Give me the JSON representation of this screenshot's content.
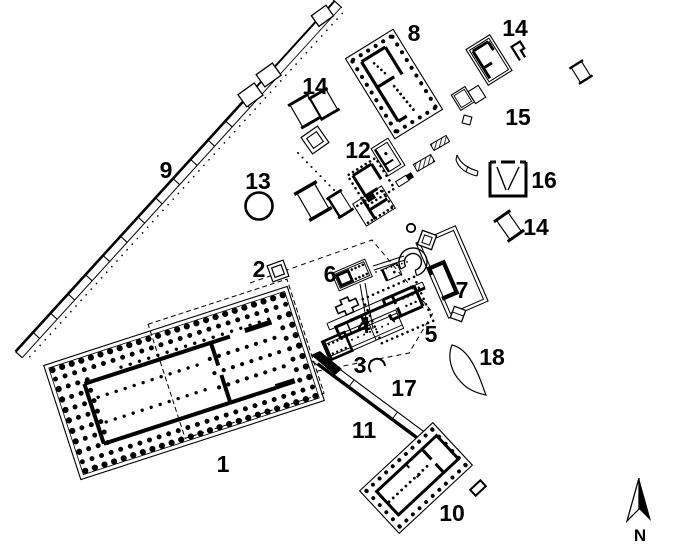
{
  "palette": {
    "ink": "#000000",
    "paper": "#ffffff"
  },
  "labels": [
    {
      "id": "structure-1",
      "text": "1"
    },
    {
      "id": "structure-2",
      "text": "2"
    },
    {
      "id": "structure-3",
      "text": "3"
    },
    {
      "id": "structure-4",
      "text": "4"
    },
    {
      "id": "structure-5",
      "text": "5"
    },
    {
      "id": "structure-6",
      "text": "6"
    },
    {
      "id": "structure-7",
      "text": "7"
    },
    {
      "id": "structure-8",
      "text": "8"
    },
    {
      "id": "structure-9",
      "text": "9"
    },
    {
      "id": "structure-10",
      "text": "10"
    },
    {
      "id": "structure-11",
      "text": "11"
    },
    {
      "id": "structure-12",
      "text": "12"
    },
    {
      "id": "structure-13",
      "text": "13"
    },
    {
      "id": "structure-14-west",
      "text": "14"
    },
    {
      "id": "structure-14-north",
      "text": "14"
    },
    {
      "id": "structure-14-east",
      "text": "14"
    },
    {
      "id": "structure-15",
      "text": "15"
    },
    {
      "id": "structure-16",
      "text": "16"
    },
    {
      "id": "structure-17",
      "text": "17"
    },
    {
      "id": "structure-18",
      "text": "18"
    }
  ],
  "north": {
    "label": "N"
  }
}
